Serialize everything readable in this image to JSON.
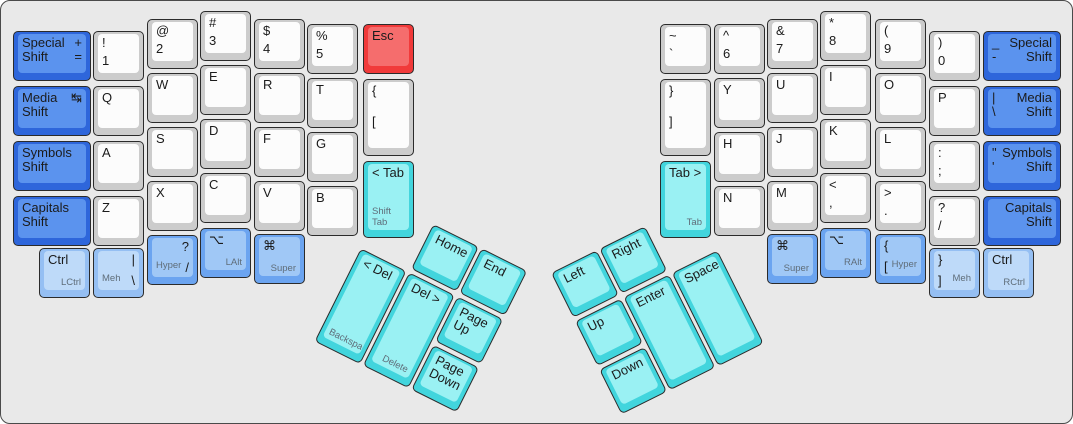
{
  "board": {
    "description": "ErgoDox split ergonomic keyboard layout",
    "background": "#e9e9e9",
    "border_color": "#4a4a4a"
  },
  "palette": {
    "white": {
      "base": "#cccccc",
      "cap": "#fcfcfc"
    },
    "blue": {
      "base": "#2e66db",
      "cap": "#5b93ee"
    },
    "medblue": {
      "base": "#6ba4f0",
      "cap": "#a0c8f6"
    },
    "lightblue": {
      "base": "#95bff3",
      "cap": "#bedaf9"
    },
    "cyan": {
      "base": "#42d5dd",
      "cap": "#9af1f3"
    },
    "red": {
      "base": "#f13a3a",
      "cap": "#f56d6d"
    }
  },
  "legend_colors": {
    "main": "#1b1b1b",
    "sub": "#5f6d79"
  },
  "groups": {
    "left-thumb-cluster": {
      "x": 384,
      "y": 199,
      "angle": 26.5
    },
    "right-thumb-cluster": {
      "x": 550,
      "y": 272,
      "angle": -26.5
    }
  },
  "keys": [
    {
      "name": "special-shift-left",
      "x": 12,
      "y": 30,
      "w": 78,
      "h": 50,
      "color": "blue",
      "tl": "Special\nShift",
      "tr": "+\n="
    },
    {
      "name": "media-shift-left",
      "x": 12,
      "y": 85,
      "w": 78,
      "h": 50,
      "color": "blue",
      "tl": "Media\nShift",
      "tr": "↹",
      "icons": {
        "tr": "tab-arrows-icon"
      }
    },
    {
      "name": "symbols-shift-left",
      "x": 12,
      "y": 140,
      "w": 78,
      "h": 50,
      "color": "blue",
      "tl": "Symbols\nShift"
    },
    {
      "name": "capitals-shift-left",
      "x": 12,
      "y": 195,
      "w": 78,
      "h": 50,
      "color": "blue",
      "tl": "Capitals\nShift"
    },
    {
      "name": "key-1",
      "x": 92,
      "y": 30,
      "color": "white",
      "tl": "!",
      "ml": "1"
    },
    {
      "name": "key-q",
      "x": 92,
      "y": 85,
      "color": "white",
      "tl": "Q"
    },
    {
      "name": "key-a",
      "x": 92,
      "y": 140,
      "color": "white",
      "tl": "A"
    },
    {
      "name": "key-z",
      "x": 92,
      "y": 195,
      "color": "white",
      "tl": "Z"
    },
    {
      "name": "key-2",
      "x": 146,
      "y": 18,
      "color": "white",
      "tl": "@",
      "ml": "2"
    },
    {
      "name": "key-w",
      "x": 146,
      "y": 72,
      "color": "white",
      "tl": "W"
    },
    {
      "name": "key-s",
      "x": 146,
      "y": 126,
      "color": "white",
      "tl": "S"
    },
    {
      "name": "key-x",
      "x": 146,
      "y": 180,
      "color": "white",
      "tl": "X"
    },
    {
      "name": "key-3",
      "x": 199,
      "y": 10,
      "color": "white",
      "tl": "#",
      "ml": "3"
    },
    {
      "name": "key-e",
      "x": 199,
      "y": 64,
      "color": "white",
      "tl": "E"
    },
    {
      "name": "key-d",
      "x": 199,
      "y": 118,
      "color": "white",
      "tl": "D"
    },
    {
      "name": "key-c",
      "x": 199,
      "y": 172,
      "color": "white",
      "tl": "C"
    },
    {
      "name": "key-4",
      "x": 253,
      "y": 18,
      "color": "white",
      "tl": "$",
      "ml": "4"
    },
    {
      "name": "key-r",
      "x": 253,
      "y": 72,
      "color": "white",
      "tl": "R"
    },
    {
      "name": "key-f",
      "x": 253,
      "y": 126,
      "color": "white",
      "tl": "F"
    },
    {
      "name": "key-v",
      "x": 253,
      "y": 180,
      "color": "white",
      "tl": "V"
    },
    {
      "name": "key-5",
      "x": 306,
      "y": 23,
      "color": "white",
      "tl": "%",
      "ml": "5"
    },
    {
      "name": "key-t",
      "x": 306,
      "y": 77,
      "color": "white",
      "tl": "T"
    },
    {
      "name": "key-g",
      "x": 306,
      "y": 131,
      "color": "white",
      "tl": "G"
    },
    {
      "name": "key-b",
      "x": 306,
      "y": 185,
      "color": "white",
      "tl": "B"
    },
    {
      "name": "key-esc",
      "x": 362,
      "y": 23,
      "color": "red",
      "tl": "Esc"
    },
    {
      "name": "key-lbrace-left",
      "x": 362,
      "y": 78,
      "h": 77,
      "color": "white",
      "tl": "{",
      "ml": "["
    },
    {
      "name": "key-tab-left",
      "x": 362,
      "y": 160,
      "h": 77,
      "color": "cyan",
      "tl": "< Tab",
      "subr": "Shift Tab"
    },
    {
      "name": "key-lctrl",
      "x": 38,
      "y": 247,
      "color": "lightblue",
      "tl": "Ctrl",
      "subr": "LCtrl"
    },
    {
      "name": "key-meh-left",
      "x": 92,
      "y": 247,
      "color": "lightblue",
      "tr": "|",
      "br": "\\",
      "subl": "Meh"
    },
    {
      "name": "key-hyper-left",
      "x": 146,
      "y": 234,
      "color": "medblue",
      "tr": "?",
      "br": "/",
      "subl": "Hyper"
    },
    {
      "name": "key-lalt",
      "x": 199,
      "y": 227,
      "color": "medblue",
      "tl": "⌥",
      "subr": "LAlt",
      "icons": {
        "tl": "option-icon"
      }
    },
    {
      "name": "key-super-left",
      "x": 253,
      "y": 233,
      "color": "medblue",
      "tl": "⌘",
      "subr": "Super",
      "icons": {
        "tl": "command-icon"
      }
    },
    {
      "name": "key-home",
      "g": "left-thumb-cluster",
      "x": 54,
      "y": 0,
      "color": "cyan",
      "tl": "Home"
    },
    {
      "name": "key-end",
      "g": "left-thumb-cluster",
      "x": 108,
      "y": 0,
      "color": "cyan",
      "tl": "End"
    },
    {
      "name": "key-backspace",
      "g": "left-thumb-cluster",
      "x": 0,
      "y": 54,
      "h": 104,
      "color": "cyan",
      "tl": "< Del",
      "subl": "Backspace"
    },
    {
      "name": "key-delete",
      "g": "left-thumb-cluster",
      "x": 54,
      "y": 54,
      "h": 104,
      "color": "cyan",
      "tl": "Del >",
      "subr": "Delete"
    },
    {
      "name": "key-page-up",
      "g": "left-thumb-cluster",
      "x": 108,
      "y": 54,
      "color": "cyan",
      "tl": "Page\nUp"
    },
    {
      "name": "key-page-down",
      "g": "left-thumb-cluster",
      "x": 108,
      "y": 108,
      "color": "cyan",
      "tl": "Page\nDown"
    },
    {
      "name": "key-grave",
      "x": 659,
      "y": 23,
      "color": "white",
      "tl": "~",
      "ml": "`"
    },
    {
      "name": "key-rbrace-right",
      "x": 659,
      "y": 78,
      "h": 77,
      "color": "white",
      "tl": "}",
      "ml": "]"
    },
    {
      "name": "key-tab-right",
      "x": 659,
      "y": 160,
      "h": 77,
      "color": "cyan",
      "tl": "Tab >",
      "subr": "Tab"
    },
    {
      "name": "key-6",
      "x": 713,
      "y": 23,
      "color": "white",
      "tl": "^",
      "ml": "6"
    },
    {
      "name": "key-y",
      "x": 713,
      "y": 77,
      "color": "white",
      "tl": "Y"
    },
    {
      "name": "key-h",
      "x": 713,
      "y": 131,
      "color": "white",
      "tl": "H"
    },
    {
      "name": "key-n",
      "x": 713,
      "y": 185,
      "color": "white",
      "tl": "N"
    },
    {
      "name": "key-7",
      "x": 766,
      "y": 18,
      "color": "white",
      "tl": "&",
      "ml": "7"
    },
    {
      "name": "key-u",
      "x": 766,
      "y": 72,
      "color": "white",
      "tl": "U"
    },
    {
      "name": "key-j",
      "x": 766,
      "y": 126,
      "color": "white",
      "tl": "J"
    },
    {
      "name": "key-m",
      "x": 766,
      "y": 180,
      "color": "white",
      "tl": "M"
    },
    {
      "name": "key-8",
      "x": 819,
      "y": 10,
      "color": "white",
      "tl": "*",
      "ml": "8"
    },
    {
      "name": "key-i",
      "x": 819,
      "y": 64,
      "color": "white",
      "tl": "I"
    },
    {
      "name": "key-k",
      "x": 819,
      "y": 118,
      "color": "white",
      "tl": "K"
    },
    {
      "name": "key-comma",
      "x": 819,
      "y": 172,
      "color": "white",
      "tl": "<",
      "ml": ","
    },
    {
      "name": "key-9",
      "x": 874,
      "y": 18,
      "color": "white",
      "tl": "(",
      "ml": "9"
    },
    {
      "name": "key-o",
      "x": 874,
      "y": 72,
      "color": "white",
      "tl": "O"
    },
    {
      "name": "key-l",
      "x": 874,
      "y": 126,
      "color": "white",
      "tl": "L"
    },
    {
      "name": "key-period",
      "x": 874,
      "y": 180,
      "color": "white",
      "tl": ">",
      "ml": "."
    },
    {
      "name": "key-0",
      "x": 928,
      "y": 30,
      "color": "white",
      "tl": ")",
      "ml": "0"
    },
    {
      "name": "key-p",
      "x": 928,
      "y": 85,
      "color": "white",
      "tl": "P"
    },
    {
      "name": "key-semicolon",
      "x": 928,
      "y": 140,
      "color": "white",
      "tl": ":",
      "ml": ";"
    },
    {
      "name": "key-slash",
      "x": 928,
      "y": 195,
      "color": "white",
      "tl": "?",
      "ml": "/"
    },
    {
      "name": "special-shift-right",
      "x": 982,
      "y": 30,
      "w": 78,
      "h": 50,
      "color": "blue",
      "tl": "_\n-",
      "tr": "Special\nShift"
    },
    {
      "name": "media-shift-right",
      "x": 982,
      "y": 85,
      "w": 78,
      "h": 50,
      "color": "blue",
      "tl": "|\n\\",
      "tr": "Media\nShift"
    },
    {
      "name": "symbols-shift-right",
      "x": 982,
      "y": 140,
      "w": 78,
      "h": 50,
      "color": "blue",
      "tl": "\"\n'",
      "tr": "Symbols\nShift"
    },
    {
      "name": "capitals-shift-right",
      "x": 982,
      "y": 195,
      "w": 78,
      "h": 50,
      "color": "blue",
      "tr": "Capitals\nShift"
    },
    {
      "name": "key-super-right",
      "x": 766,
      "y": 233,
      "color": "medblue",
      "tl": "⌘",
      "subr": "Super",
      "icons": {
        "tl": "command-icon"
      }
    },
    {
      "name": "key-ralt",
      "x": 819,
      "y": 227,
      "color": "medblue",
      "tl": "⌥",
      "subr": "RAlt",
      "icons": {
        "tl": "option-icon"
      }
    },
    {
      "name": "key-hyper-right",
      "x": 874,
      "y": 233,
      "color": "medblue",
      "tl": "{",
      "bl": "[",
      "subr": "Hyper"
    },
    {
      "name": "key-meh-right",
      "x": 928,
      "y": 247,
      "color": "lightblue",
      "tl": "}",
      "bl": "]",
      "subr": "Meh"
    },
    {
      "name": "key-rctrl",
      "x": 982,
      "y": 247,
      "color": "lightblue",
      "tl": "Ctrl",
      "subr": "RCtrl"
    },
    {
      "name": "key-arrow-left",
      "g": "right-thumb-cluster",
      "x": 0,
      "y": 0,
      "color": "cyan",
      "tl": "Left"
    },
    {
      "name": "key-arrow-right",
      "g": "right-thumb-cluster",
      "x": 54,
      "y": 0,
      "color": "cyan",
      "tl": "Right"
    },
    {
      "name": "key-arrow-up",
      "g": "right-thumb-cluster",
      "x": 0,
      "y": 54,
      "color": "cyan",
      "tl": "Up"
    },
    {
      "name": "key-arrow-down",
      "g": "right-thumb-cluster",
      "x": 0,
      "y": 108,
      "color": "cyan",
      "tl": "Down"
    },
    {
      "name": "key-enter",
      "g": "right-thumb-cluster",
      "x": 54,
      "y": 54,
      "h": 104,
      "color": "cyan",
      "tl": "Enter"
    },
    {
      "name": "key-space",
      "g": "right-thumb-cluster",
      "x": 108,
      "y": 54,
      "h": 104,
      "color": "cyan",
      "tl": "Space"
    }
  ]
}
